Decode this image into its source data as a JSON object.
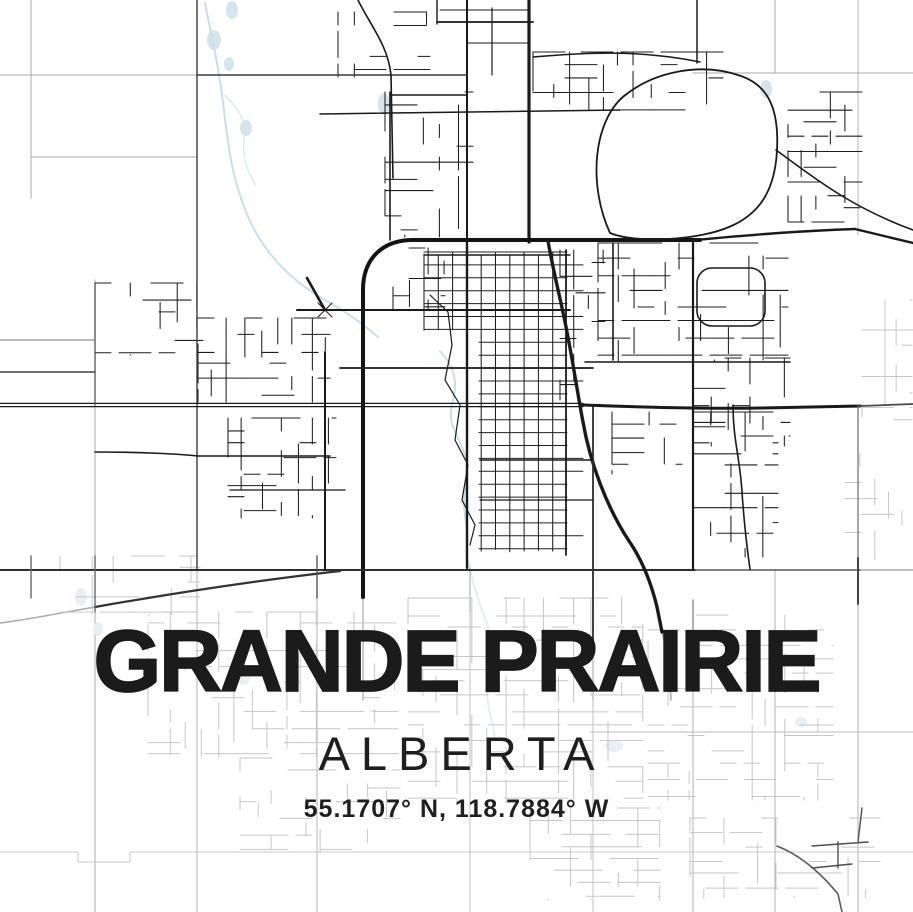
{
  "poster": {
    "title": "GRANDE PRAIRIE",
    "subtitle": "ALBERTA",
    "coordinates": "55.1707° N, 118.7884° W"
  },
  "colors": {
    "background": "#ffffff",
    "road_black": "#1a1a1a",
    "road_medium": "#3c3c3c",
    "road_faded": "#c6c6c6",
    "section_grid": "#a9a9a9",
    "water": "#d5e5ee",
    "water_faded": "#e7f0f5",
    "creek": "#c9e0ec",
    "text": "#1b1b1b"
  }
}
